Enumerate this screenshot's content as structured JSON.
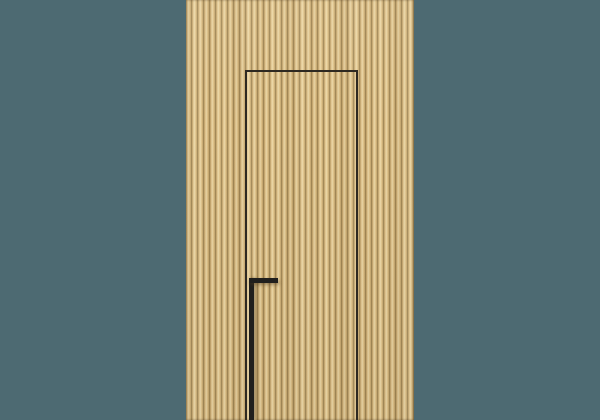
{
  "scene": {
    "description": "Concealed flush interior door with an integrated black full-height pull handle, hidden within a floor-to-ceiling vertical wood slat wall panel, shown against a plain teal wall",
    "elements": {
      "background": "teal wall backdrop",
      "slat_panel": "vertical oak slat wall panel, full height",
      "door": "hidden flush door, shadow-gap outline only, slats continue across the leaf",
      "handle": "matte black L-shaped pull handle running from mid-height to the floor"
    }
  },
  "colors": {
    "background-teal": "#4d6a72",
    "wood-light": "#ecd9a9",
    "wood-mid": "#dcbf87",
    "wood-edge": "#b3945c",
    "wood-groove": "#8f784a",
    "door-gap-line": "#2e2921",
    "handle-black": "#201f1d"
  }
}
